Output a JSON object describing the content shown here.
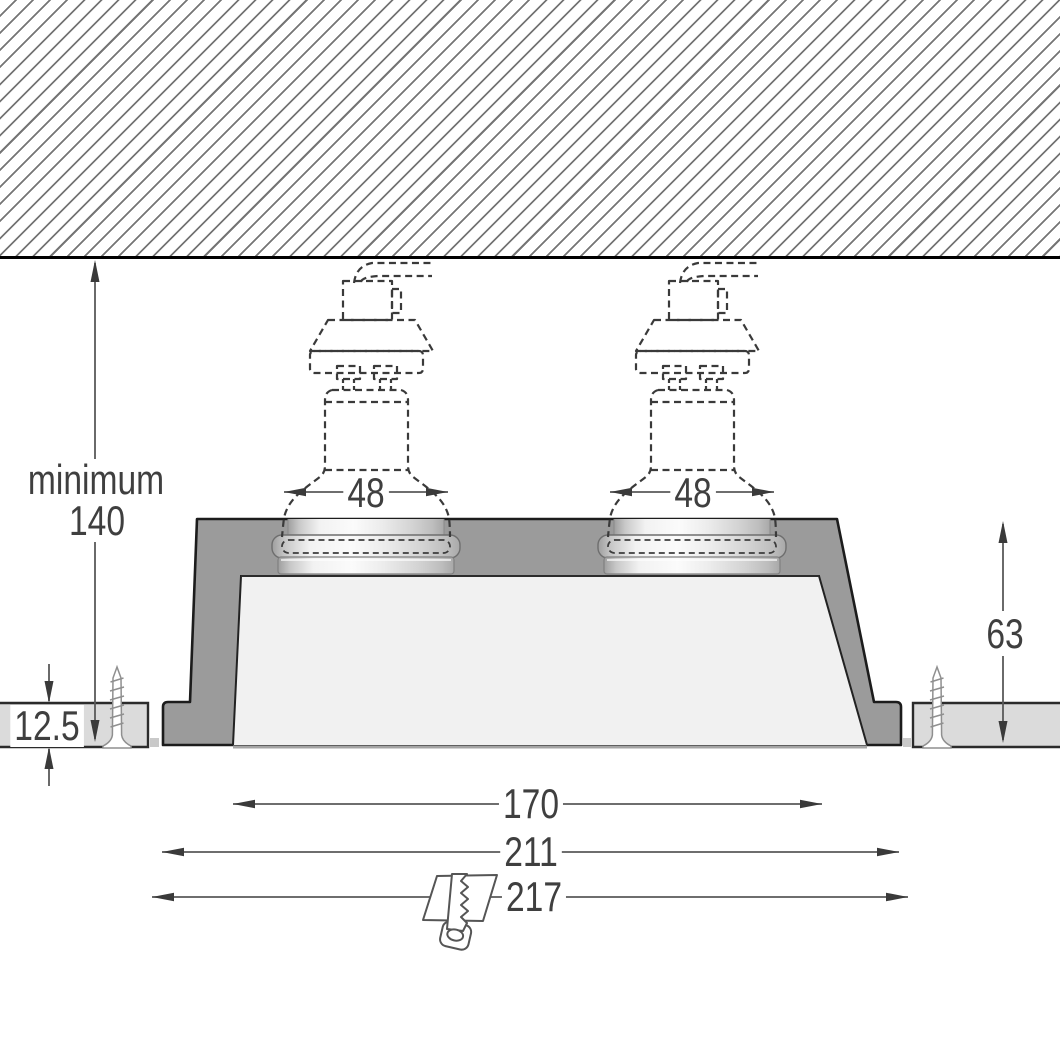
{
  "dimensions": {
    "recess_depth": {
      "prefix": "minimum",
      "value": "140"
    },
    "lamp_opening_left": {
      "value": "48"
    },
    "lamp_opening_right": {
      "value": "48"
    },
    "board_thickness": {
      "value": "12.5"
    },
    "body_height": {
      "value": "63"
    },
    "aperture_width": {
      "value": "170"
    },
    "body_width": {
      "value": "211"
    },
    "cutout_width": {
      "value": "217"
    }
  },
  "icons": {
    "screw": "screw-icon",
    "saw": "saw-icon",
    "lamp": "gu10-lamp-outline-icon"
  },
  "colors": {
    "fixture_gray": "#9b9b9b",
    "board_gray": "#dbdbdb",
    "cavity_gray": "#f1f1f1",
    "outline_dark": "#1c1c1c",
    "dimension_line": "#5a5a5a",
    "arrow_fill": "#3a3a3a",
    "label_text": "#3f3f3f",
    "hatch_line": "#757575"
  }
}
